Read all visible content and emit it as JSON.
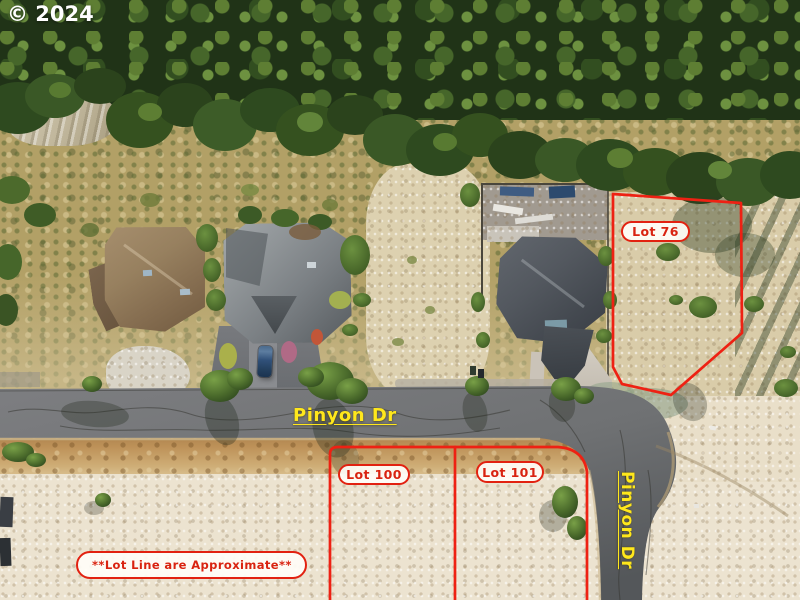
{
  "watermark": {
    "text": "© 2024",
    "color": "#ffffff"
  },
  "street_labels": {
    "horizontal": "Pinyon Dr",
    "vertical": "Pinyon Dr",
    "color": "#ffe71c"
  },
  "lot_labels": {
    "lot76": "Lot 76",
    "lot100": "Lot 100",
    "lot101": "Lot 101"
  },
  "disclaimer": "**Lot Line are Approximate**",
  "colors": {
    "lot_line": "#ee2113",
    "label_text": "#d92310",
    "pill_background": "#fffdf8",
    "road": "#6f7173",
    "sand": "#ece3d1"
  }
}
